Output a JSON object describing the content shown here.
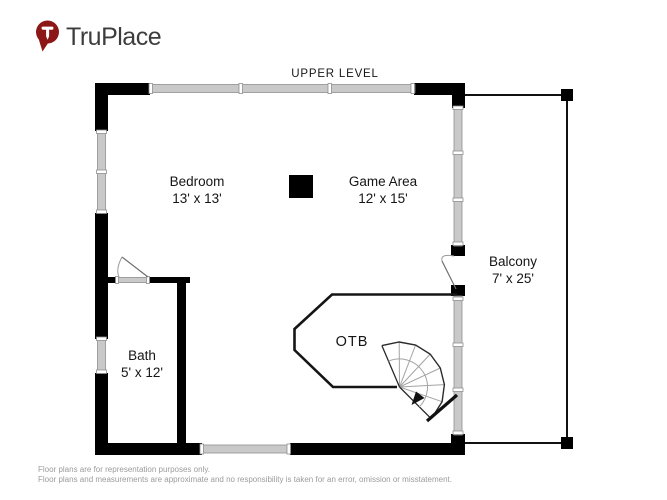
{
  "brand": {
    "name": "TruPlace",
    "pin_icon": "map-pin-with-T",
    "pin_color": "#8b1717",
    "text_color": "#3d3d3d"
  },
  "plan": {
    "title": "UPPER LEVEL",
    "rooms": {
      "bedroom": {
        "name": "Bedroom",
        "dims": "13' x 13'"
      },
      "game_area": {
        "name": "Game Area",
        "dims": "12' x 15'"
      },
      "balcony": {
        "name": "Balcony",
        "dims": "7' x 25'"
      },
      "bath": {
        "name": "Bath",
        "dims": "5' x 12'"
      },
      "otb": {
        "name": "OTB"
      }
    },
    "features": {
      "stairs_icon": "spiral-staircase",
      "direction_icon": "down-arrow",
      "door_icons": "door-swing",
      "column_icon": "structural-column"
    },
    "colors": {
      "wall": "#000000",
      "window_fill": "#c9c9c9",
      "window_edge": "#8f8f8f",
      "thin_wall": "#151515",
      "stair_spoke": "#a3a3a3"
    }
  },
  "footer": {
    "line1": "Floor plans are for representation purposes only.",
    "line2": "Floor plans and measurements are approximate and no responsibility is taken for an error, omission or misstatement."
  }
}
